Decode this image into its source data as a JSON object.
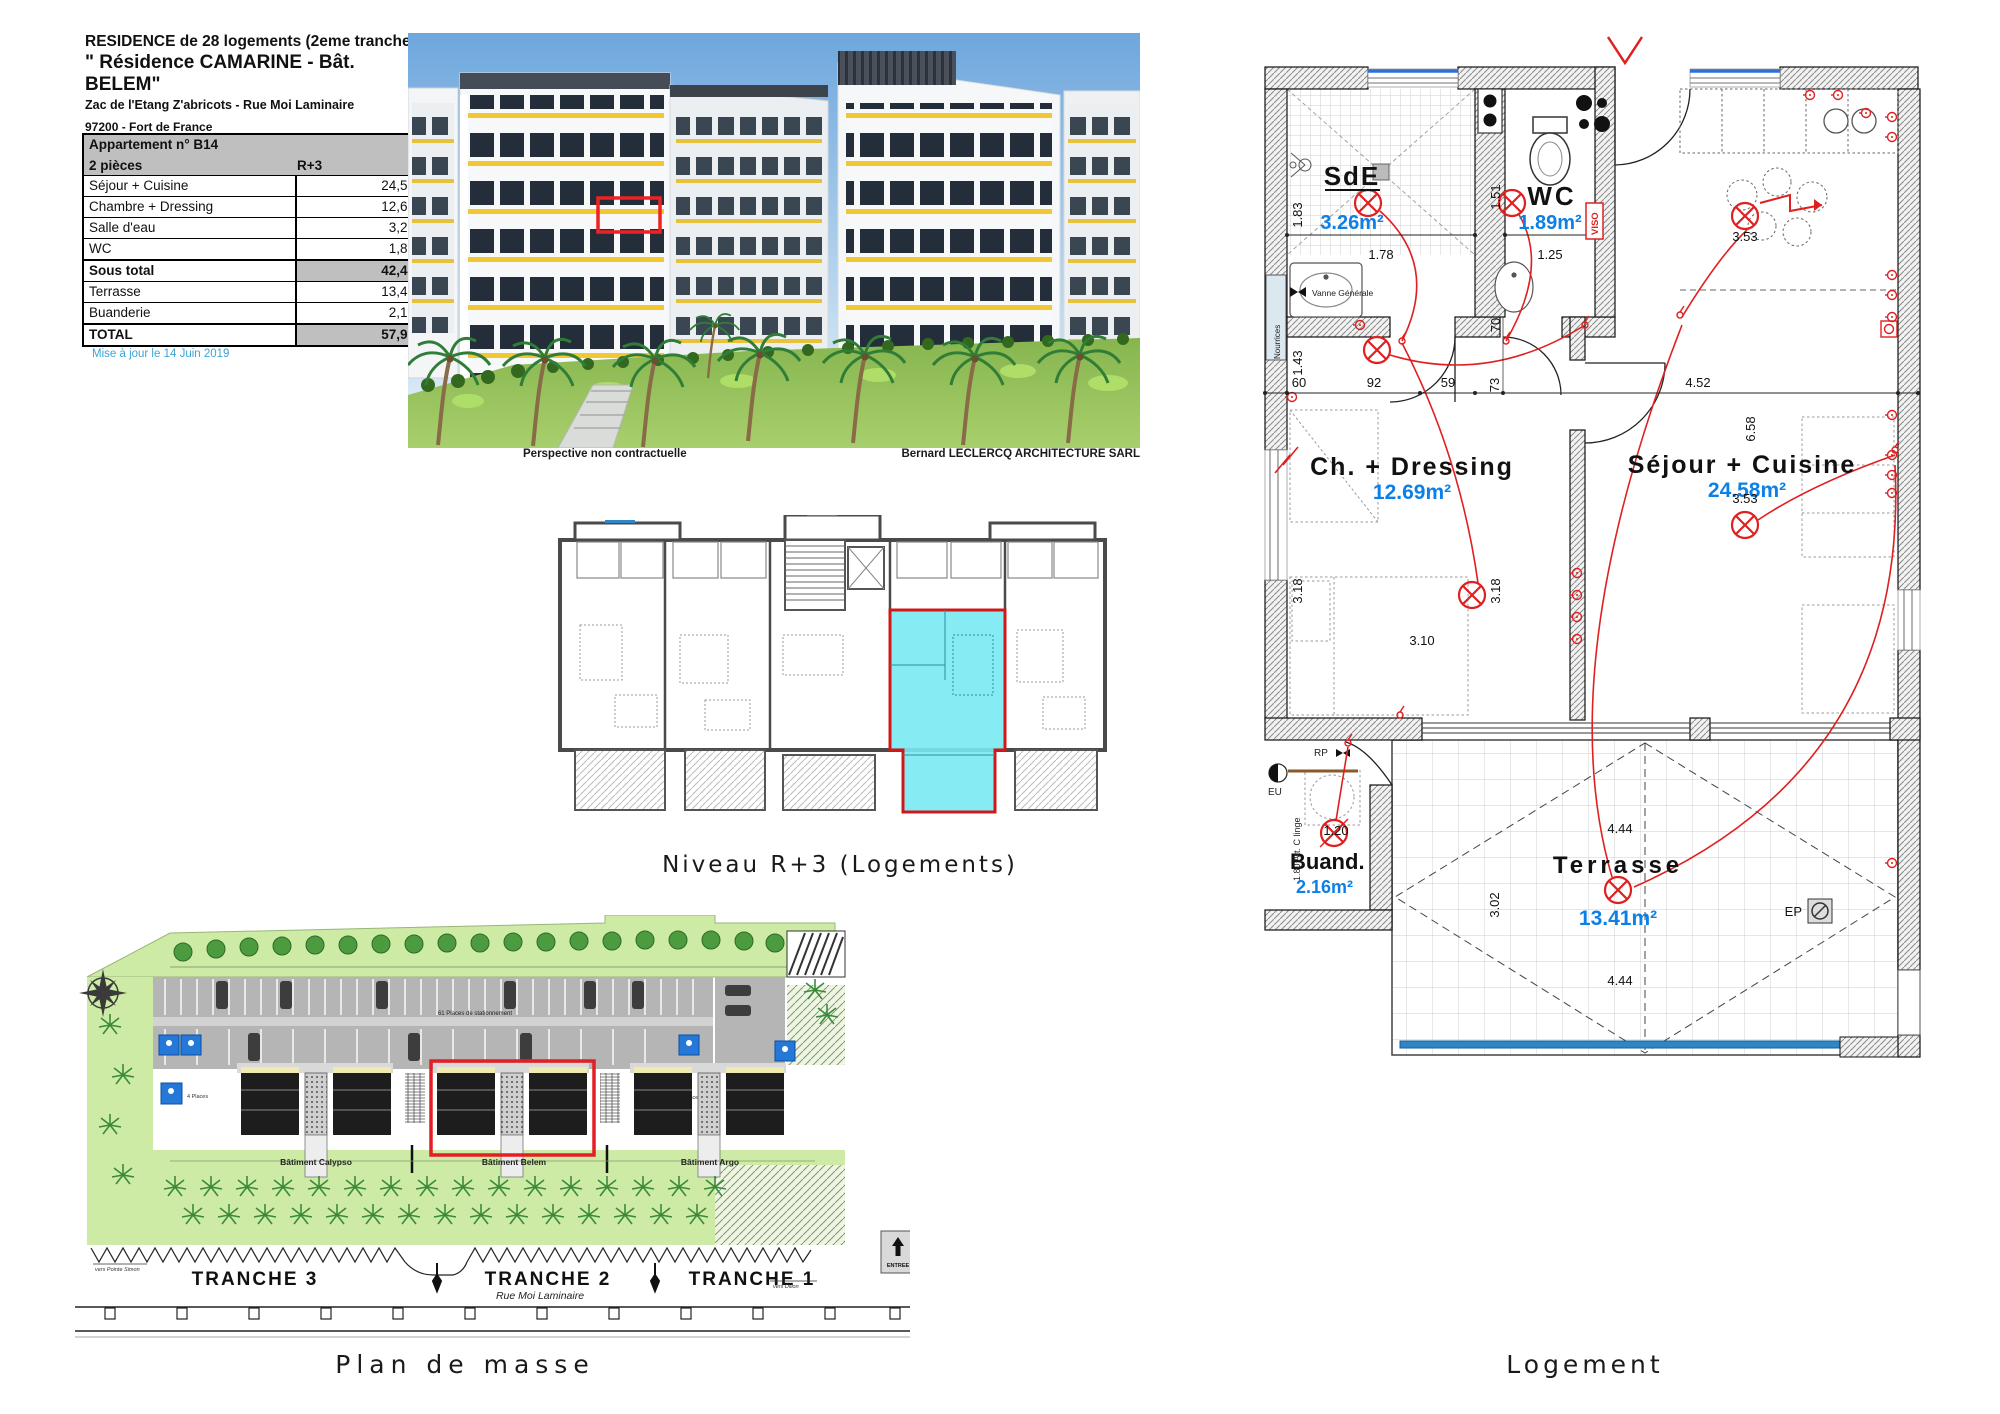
{
  "header": {
    "title_line1": "RESIDENCE de 28 logements (2eme tranche)",
    "title_line2": "\" Résidence CAMARINE - Bât. BELEM\"",
    "address_line1": "Zac de l'Etang Z'abricots - Rue Moi Laminaire",
    "address_line2": "97200  - Fort de France"
  },
  "area_table": {
    "header": {
      "apartment": "Appartement n° B14",
      "type": "2 pièces",
      "level": "R+3"
    },
    "rows": [
      {
        "label": "Séjour + Cuisine",
        "value": "24,58"
      },
      {
        "label": "Chambre + Dressing",
        "value": "12,69"
      },
      {
        "label": "Salle d'eau",
        "value": "3,26"
      },
      {
        "label": "WC",
        "value": "1,89"
      }
    ],
    "subtotal": {
      "label": "Sous total",
      "value": "42,42"
    },
    "rows2": [
      {
        "label": "Terrasse",
        "value": "13,41"
      },
      {
        "label": "Buanderie",
        "value": "2,16"
      }
    ],
    "total": {
      "label": "TOTAL",
      "value": "57,99"
    },
    "updated": "Mise à jour le 14 Juin 2019"
  },
  "perspective": {
    "caption_left": "Perspective non contractuelle",
    "caption_right": "Bernard LECLERCQ ARCHITECTURE SARL"
  },
  "floor_plan": {
    "caption": "Niveau R+3 (Logements)"
  },
  "site_plan": {
    "caption": "Plan de masse",
    "parking_label": "61 Places de stationnement",
    "places_left": "4 Places",
    "places_right": "6 Places",
    "buildings": [
      "Bâtiment Calypso",
      "Bâtiment Belem",
      "Bâtiment Argo"
    ],
    "tranches": [
      "TRANCHE 3",
      "TRANCHE 2",
      "TRANCHE 1"
    ],
    "street": "Rue Moi Laminaire",
    "entree": "ENTREE",
    "dir_left": "vers Pointe Simon",
    "dir_right": "vers Dillon"
  },
  "apartment_plan": {
    "caption": "Logement",
    "rooms": [
      {
        "name": "SdE",
        "area": "3.26m²"
      },
      {
        "name": "WC",
        "area": "1.89m²"
      },
      {
        "name": "Ch. + Dressing",
        "area": "12.69m²"
      },
      {
        "name": "Séjour + Cuisine",
        "area": "24.58m²"
      },
      {
        "name": "Buand.",
        "area": "2.16m²"
      },
      {
        "name": "Terrasse",
        "area": "13.41m²"
      }
    ],
    "dims": {
      "v183": "1.83",
      "h178": "1.78",
      "v151": "1.51",
      "h125": "1.25",
      "v70": "70",
      "v143": "1.43",
      "h60": "60",
      "h92": "92",
      "h59": "59",
      "v73": "73",
      "h452": "4.52",
      "v658": "6.58",
      "h353_top": "3.53",
      "h353_mid": "3.53",
      "v318_left": "3.18",
      "h310": "3.10",
      "v318_mid": "3.18",
      "h120": "1.20",
      "v302": "3.02",
      "h444_top": "4.44",
      "h444_bot": "4.44"
    },
    "annotations": {
      "vanne": "Vanne Générale",
      "nourrices": "Nourrices",
      "viso": "VISO",
      "eu": "EU",
      "rp": "RP",
      "att_linge": "1.80 Att. C linge",
      "ep": "EP"
    }
  },
  "colors": {
    "accent_red": "#E2231E",
    "area_blue": "#0D80E8",
    "update_blue": "#3AA4D8",
    "cyan_unit": "#79E9F2",
    "site_green": "#CDEBA5",
    "parking_gray": "#B5B5B5",
    "sky_blue": "#6EA7DD",
    "lawn_green": "#8FBF58",
    "accent_yellow": "#F2C832",
    "disabled_blue": "#2678D8",
    "glazing_blue": "#2E86C8"
  }
}
